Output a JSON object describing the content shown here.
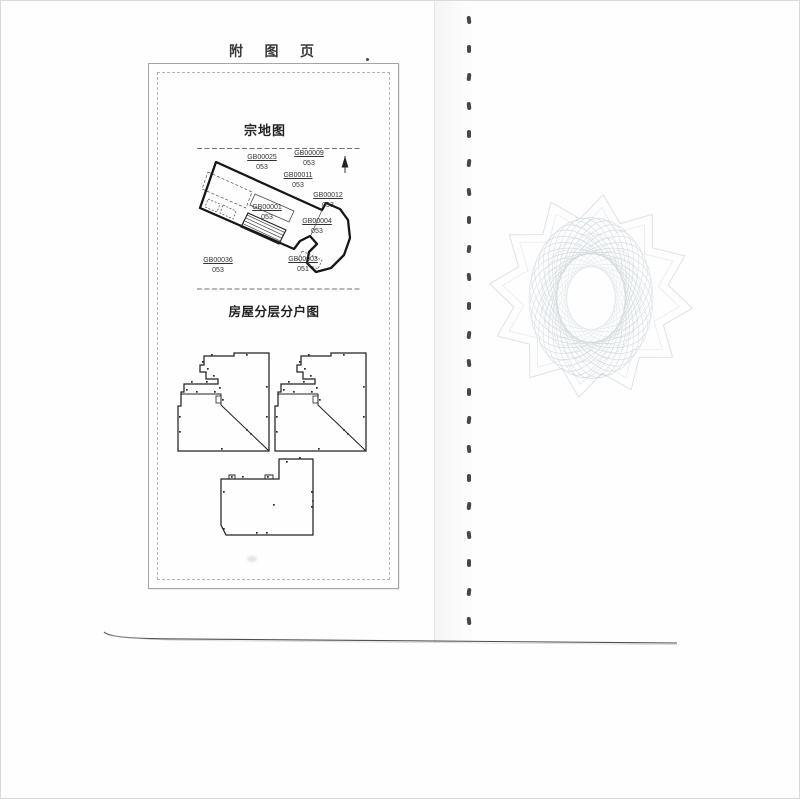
{
  "page": {
    "title": "附 图 页"
  },
  "parcel_map": {
    "title": "宗地图",
    "parcels": [
      {
        "id": "GB00025",
        "num": "053"
      },
      {
        "id": "GB00009",
        "num": "053"
      },
      {
        "id": "GB00011",
        "num": "053"
      },
      {
        "id": "GB00012",
        "num": "053"
      },
      {
        "id": "GB00001",
        "num": "053"
      },
      {
        "id": "GB00004",
        "num": "053"
      },
      {
        "id": "GB00003",
        "num": "051"
      },
      {
        "id": "GB00036",
        "num": "053"
      }
    ]
  },
  "floor_plan": {
    "title": "房屋分层分户图"
  },
  "colors": {
    "ink": "#2b2b2b",
    "map_line": "#1a1a1a",
    "box_border": "#a5a5a5",
    "watermark": "#bac7ce"
  }
}
